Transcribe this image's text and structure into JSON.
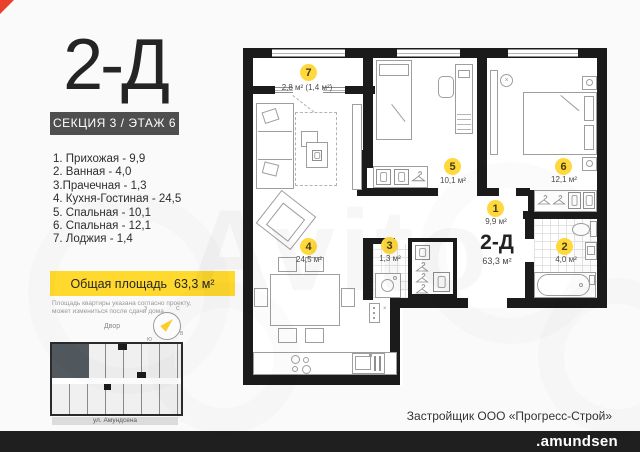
{
  "header": {
    "title": "2-Д",
    "badge": "СЕКЦИЯ 3 / ЭТАЖ 6"
  },
  "room_list": [
    "1. Прихожая - 9,9",
    "2. Ванная - 4,0",
    "3.Прачечная - 1,3",
    "4. Кухня-Гостиная - 24,5",
    "5. Спальная - 10,1",
    "6. Спальная - 12,1",
    "7. Лоджия - 1,4"
  ],
  "total": {
    "label": "Общая площадь",
    "value": "63,3 м²"
  },
  "disclaimer": {
    "line1": "Площадь квартиры указана согласно проекту,",
    "line2": "может измениться  после сдачи дома"
  },
  "minimap": {
    "yard_label": "Двор",
    "street_label": "ул. Амундсена",
    "compass": {
      "n": "С",
      "e": "В",
      "s": "Ю",
      "w": "З"
    }
  },
  "plan": {
    "unit_label": "2-Д",
    "unit_area": "63,3 м²",
    "rooms": [
      {
        "id": "1",
        "area": "9,9 м²"
      },
      {
        "id": "2",
        "area": "4,0 м²"
      },
      {
        "id": "3",
        "area": "1,3 м²"
      },
      {
        "id": "4",
        "area": "24,5 м²"
      },
      {
        "id": "5",
        "area": "10,1 м²"
      },
      {
        "id": "6",
        "area": "12,1 м²"
      },
      {
        "id": "7",
        "area": "2,8 м² (1,4 м²)"
      }
    ]
  },
  "footer": {
    "developer": "Застройщик ООО «Прогресс-Строй»",
    "brand": ".amundsen"
  },
  "watermark": {
    "text": "Avito"
  },
  "colors": {
    "accent_yellow": "#ffd92d",
    "bubble_yellow": "#ffd83d",
    "wall_black": "#1b1b1b",
    "bar_black": "#1f1f1f",
    "corner_red": "#e8412e"
  }
}
